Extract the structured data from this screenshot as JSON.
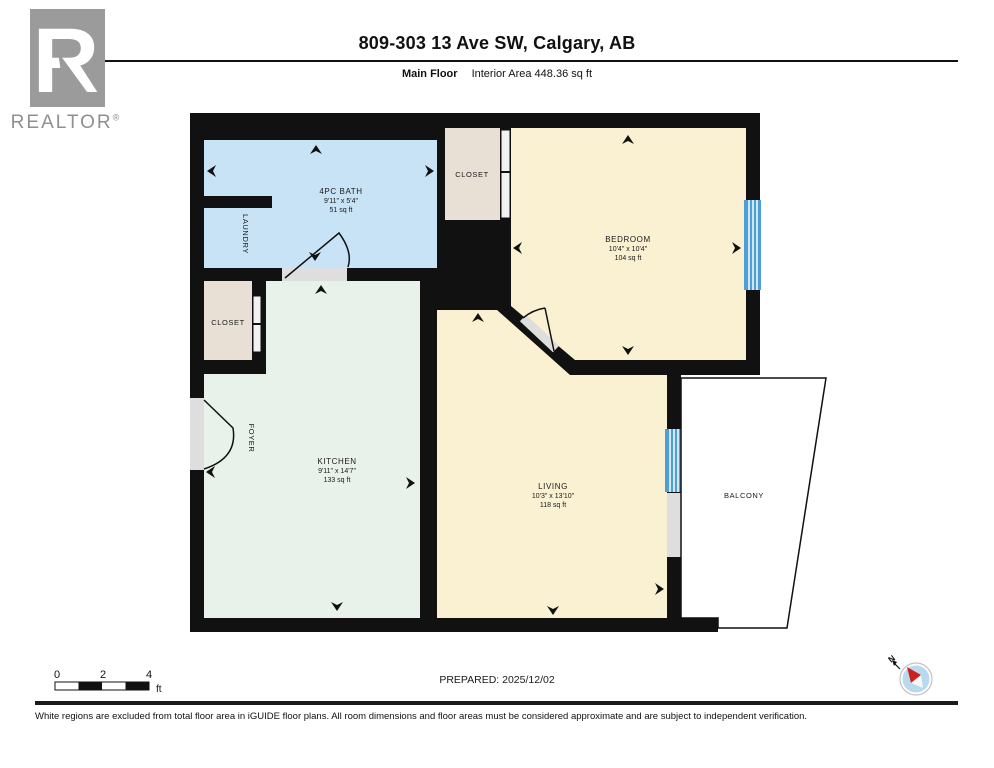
{
  "header": {
    "title": "809-303 13 Ave SW, Calgary, AB",
    "floor_label": "Main Floor",
    "area_label": "Interior Area 448.36 sq ft"
  },
  "branding": {
    "realtor": "REALTOR",
    "reg": "®"
  },
  "rooms": {
    "bath": {
      "name": "4PC BATH",
      "dims": "9'11\" x 5'4\"",
      "area": "51 sq ft"
    },
    "laundry": {
      "name": "LAUNDRY"
    },
    "closet_top": {
      "name": "CLOSET"
    },
    "closet_left": {
      "name": "CLOSET"
    },
    "foyer": {
      "name": "FOYER"
    },
    "bedroom": {
      "name": "BEDROOM",
      "dims": "10'4\" x 10'4\"",
      "area": "104 sq ft"
    },
    "kitchen": {
      "name": "KITCHEN",
      "dims": "9'11\" x 14'7\"",
      "area": "133 sq ft"
    },
    "living": {
      "name": "LIVING",
      "dims": "10'3\" x 13'10\"",
      "area": "118 sq ft"
    },
    "balcony": {
      "name": "BALCONY"
    }
  },
  "colors": {
    "wall": "#111111",
    "bath": "#c8e3f6",
    "bedroom": "#faf0d2",
    "living": "#faf0d2",
    "kitchen": "#e9f1eb",
    "closet": "#e8dfd5",
    "window": "#4f9fd4",
    "door_gray": "#dedede"
  },
  "scalebar": {
    "t0": "0",
    "t2": "2",
    "t4": "4",
    "unit": "ft"
  },
  "compass": {
    "north": "N"
  },
  "footer": {
    "prepared": "PREPARED:  2025/12/02",
    "disclaimer": "White regions are excluded from total floor area in iGUIDE floor plans. All room dimensions and floor areas must be considered approximate and are subject to independent verification."
  }
}
